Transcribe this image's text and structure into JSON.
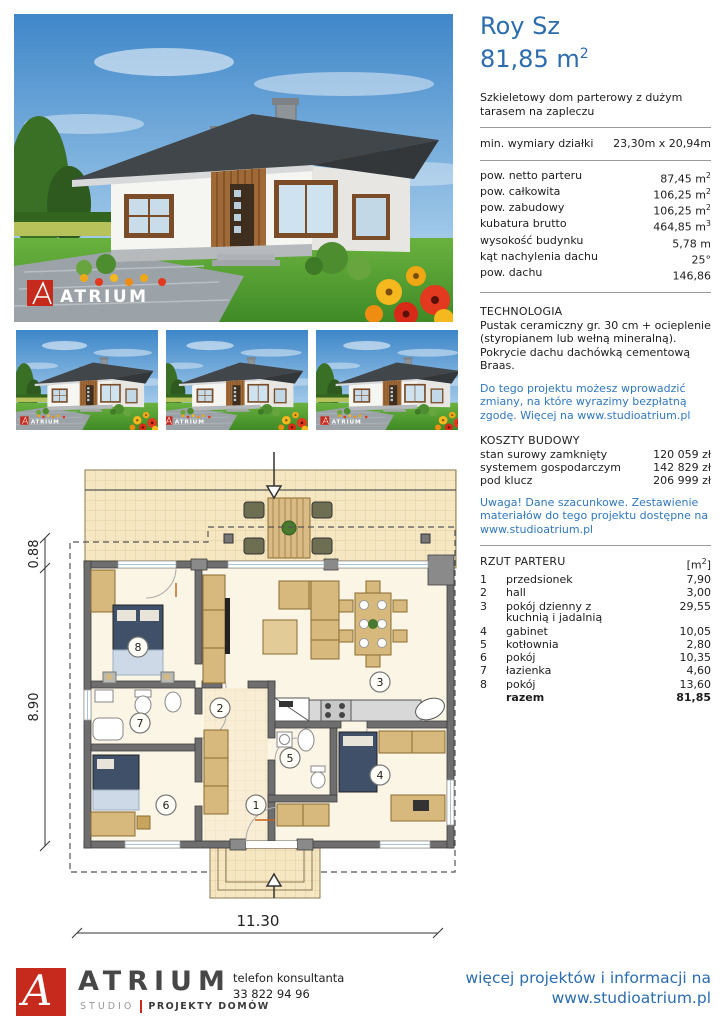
{
  "header": {
    "title": "Roy Sz",
    "area": "81,85 m",
    "area_sup": "2",
    "description": "Szkieletowy dom parterowy z dużym tarasem na zapleczu"
  },
  "plot": {
    "label": "min. wymiary działki",
    "value": "23,30m x 20,94m"
  },
  "specs": [
    {
      "label": "pow. netto parteru",
      "value": "87,45 m",
      "sup": "2"
    },
    {
      "label": "pow. całkowita",
      "value": "106,25 m",
      "sup": "2"
    },
    {
      "label": "pow. zabudowy",
      "value": "106,25 m",
      "sup": "2"
    },
    {
      "label": "kubatura brutto",
      "value": "464,85 m",
      "sup": "3"
    },
    {
      "label": "wysokość budynku",
      "value": "5,78 m"
    },
    {
      "label": "kąt nachylenia dachu",
      "value": "25°"
    },
    {
      "label": "pow. dachu",
      "value": "146,86"
    }
  ],
  "technology": {
    "heading": "TECHNOLOGIA",
    "body": "Pustak ceramiczny gr. 30 cm + ocieplenie (styropianem lub wełną mineralną). Pokrycie dachu dachówką cementową Braas.",
    "note": "Do tego projektu możesz wprowadzić zmiany, na które wyrazimy bezpłatną zgodę. Więcej na www.studioatrium.pl"
  },
  "costs": {
    "heading": "KOSZTY BUDOWY",
    "rows": [
      {
        "label": "stan surowy zamknięty",
        "value": "120 059 zł"
      },
      {
        "label": "systemem gospodarczym",
        "value": "142 829 zł"
      },
      {
        "label": "pod klucz",
        "value": "206 999 zł"
      }
    ],
    "note": "Uwaga! Dane szacunkowe. Zestawienie materiałów do tego projektu dostępne na www.studioatrium.pl"
  },
  "rooms": {
    "heading": "RZUT PARTERU",
    "unit_pre": "[m",
    "unit_sup": "2",
    "unit_post": "]",
    "rows": [
      {
        "no": "1",
        "name": "przedsionek",
        "area": "7,90"
      },
      {
        "no": "2",
        "name": "hall",
        "area": "3,00"
      },
      {
        "no": "3",
        "name": "pokój dzienny z kuchnią i jadalnią",
        "area": "29,55"
      },
      {
        "no": "4",
        "name": "gabinet",
        "area": "10,05"
      },
      {
        "no": "5",
        "name": "kotłownia",
        "area": "2,80"
      },
      {
        "no": "6",
        "name": "pokój",
        "area": "10,35"
      },
      {
        "no": "7",
        "name": "łazienka",
        "area": "4,60"
      },
      {
        "no": "8",
        "name": "pokój",
        "area": "13,60"
      }
    ],
    "total_label": "razem",
    "total_value": "81,85"
  },
  "plan": {
    "dim_terrace": "0.88",
    "dim_depth": "8.90",
    "dim_width": "11.30"
  },
  "images": {
    "watermark": "ATRIUM"
  },
  "footer": {
    "logo_letter": "A",
    "brand": "ATRIUM",
    "brand_sub1": "STUDIO",
    "brand_sub2": "PROJEKTY DOMÓW",
    "phone_label": "telefon konsultanta",
    "phone": "33 822 94 96",
    "more1": "więcej projektów i informacji na",
    "more2": "www.studioatrium.pl"
  },
  "colors": {
    "accent_blue": "#2b6cad",
    "link_blue": "#3077bd",
    "logo_red": "#c62a1c"
  }
}
